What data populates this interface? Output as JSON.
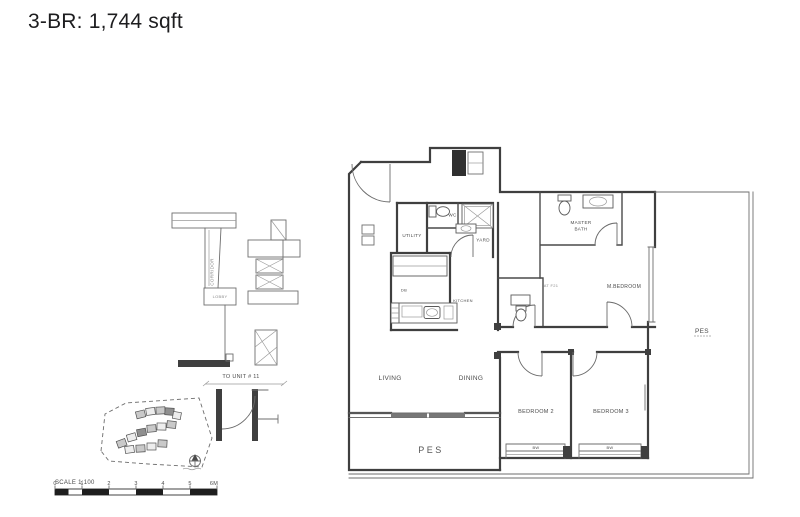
{
  "title": "3-BR: 1,744 sqft",
  "plan": {
    "utility": "UTILITY",
    "wc": "WC",
    "yard": "YARD",
    "kitchen": "KITCHEN",
    "db": "DB",
    "master_bath_1": "MASTER",
    "master_bath_2": "BATH",
    "master_bedroom": "M.BEDROOM",
    "unit_ref": "AT F21",
    "pes_right": "PES",
    "living": "LIVING",
    "dining": "DINING",
    "pes_bottom": "PES",
    "bedroom2": "BEDROOM 2",
    "bedroom3": "BEDROOM 3",
    "bw_bedroom2": "BW",
    "bw_bedroom3": "BW"
  },
  "key_plan": {
    "corridor": "CORRIDOR",
    "lobby": "LOBBY",
    "to_unit": "TO UNIT # 11"
  },
  "scale_bar": {
    "label": "SCALE 1:100",
    "ticks": [
      "0",
      "1",
      "2",
      "3",
      "4",
      "5",
      "6M"
    ]
  },
  "colors": {
    "wall": "#3f3f3f",
    "thin_line": "#6e6e6e",
    "text": "#4a4a4a",
    "background": "#ffffff"
  }
}
